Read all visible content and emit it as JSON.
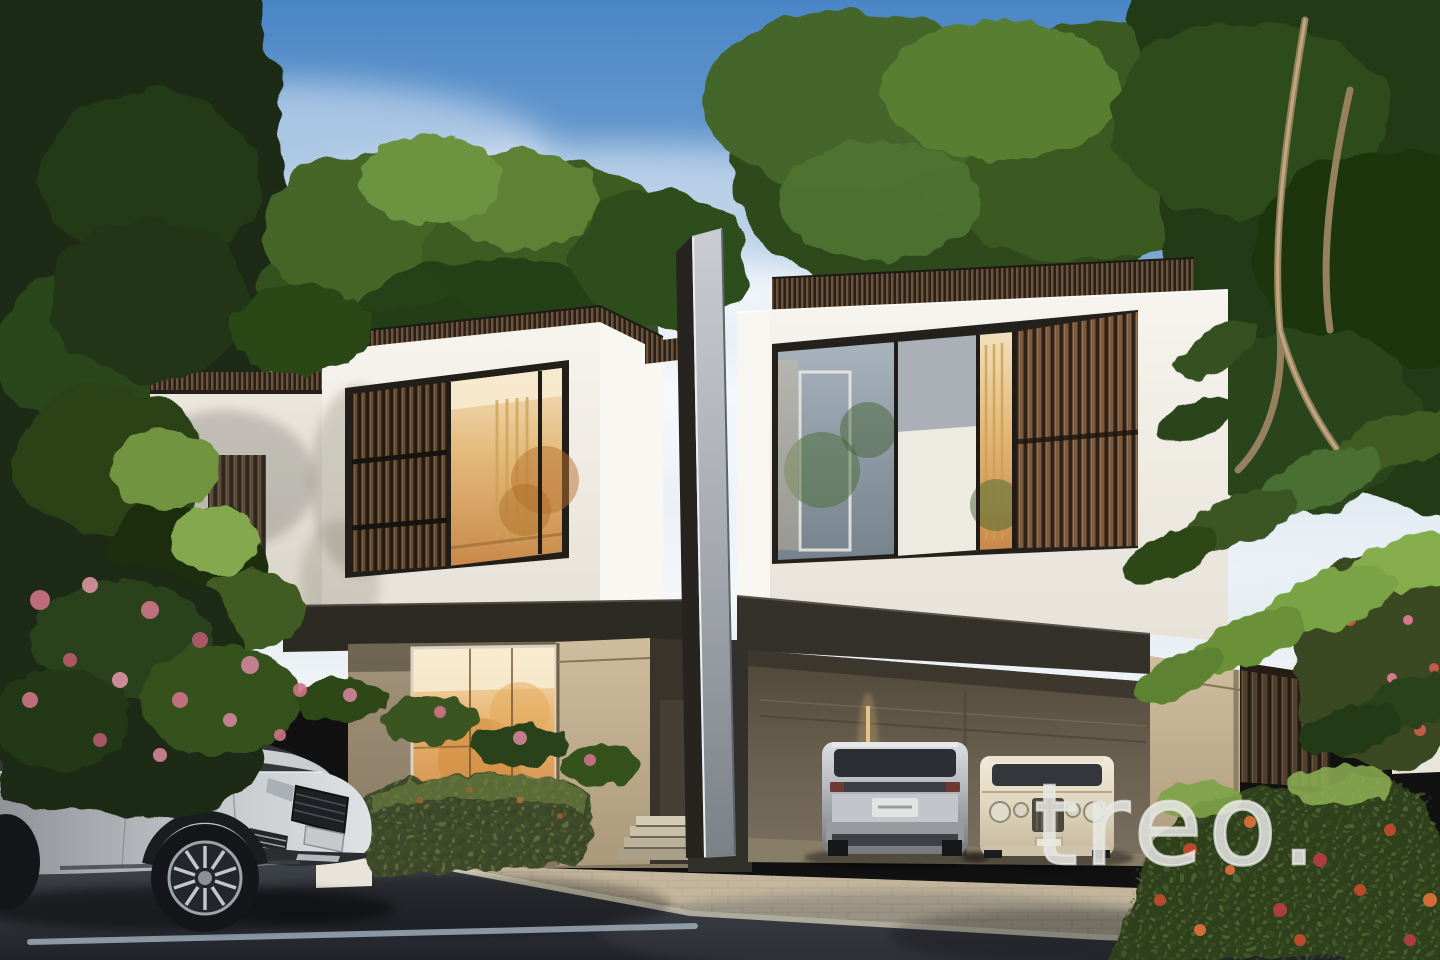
{
  "watermark": {
    "text": "treo.",
    "color": "#e7e8e4"
  },
  "scene": {
    "type": "architectural rendering photograph",
    "elements": [
      "sky",
      "clouds",
      "background-trees",
      "left-neighbor-villa",
      "left-villa",
      "divider-fin",
      "right-villa",
      "carport",
      "range-rover-street",
      "range-rover-carport",
      "bentley-carport",
      "wood-fence",
      "hedges",
      "pink-flower-tree",
      "red-flower-bush",
      "sidewalk",
      "street",
      "lane-markings"
    ],
    "palette": {
      "sky_top": "#4a86c6",
      "sky_horizon": "#f0f4f6",
      "cloud": "#ffffff",
      "wall_white": "#f4f1ea",
      "wall_white_shade": "#e2ded4",
      "wall_beige": "#c9b795",
      "wall_beige_shade": "#96876c",
      "wood_slat": "#64492f",
      "trim_dark": "#2d2a24",
      "fin_gray": "#a7abb1",
      "glass_warm": "#e4b878",
      "glass_cool": "#8d99a4",
      "foliage_dark": "#1b2a12",
      "foliage_mid": "#3c5c23",
      "foliage_light": "#84aa4c",
      "flower_pink": "#d2849a",
      "flower_red": "#c14a2c",
      "asphalt": "#2b2e34",
      "sidewalk": "#bdb097",
      "curb": "#dbd3bc",
      "car_silver": "#b9bdc2",
      "car_cream": "#ece2cd"
    }
  }
}
